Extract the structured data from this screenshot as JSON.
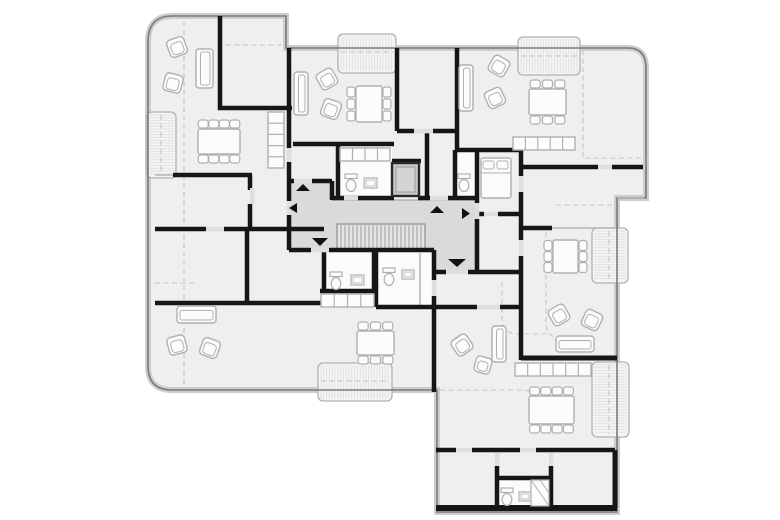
{
  "document": {
    "kind": "architectural-floor-plan",
    "canvas": {
      "width": 780,
      "height": 520
    }
  },
  "palette": {
    "background": "#ffffff",
    "room_fill": "#efefef",
    "corridor_fill": "#dadada",
    "stairs_fill": "#e4e4e4",
    "white_room_fill": "#fbfbfb",
    "balcony_fill": "#f4f4f4",
    "balcony_hatch": "#e2e2e2",
    "outline_soft": "#cdcdcd",
    "outline_dark": "#7a7a7a",
    "wall_black": "#161616",
    "gray_wall": "#b5b5b5",
    "door_sill": "#dedede",
    "dashed_line": "#c4c4c4",
    "furniture_fill": "#fcfcfc",
    "furniture_stroke": "#b0b0b0",
    "arrow_fill": "#111111",
    "elevator_fill": "#c9c9c9",
    "elevator_stroke": "#2a2a2a",
    "tread_stroke": "#8f8f8f"
  },
  "floor_plan": {
    "footprint_path": "M 172,16 L 286,16 L 286,48 L 628,48 Q 646,48 646,68 L 646,198 L 617,198 L 617,512 L 437,512 L 437,390 L 172,390 Q 148,390 148,366 L 148,42 Q 148,16 172,16 Z",
    "corridor_path": "M 289,181 L 332,181 L 332,200 L 477,200 L 477,272 L 434,272 L 434,250 L 289,250 Z",
    "stairs": {
      "x": 337,
      "y": 224,
      "w": 88,
      "h": 25,
      "tread_from": 341,
      "tread_to": 421,
      "tread_step": 4
    },
    "elevator": {
      "x": 392,
      "y": 163,
      "w": 27,
      "h": 33
    },
    "balconies": [
      {
        "x": 338,
        "y": 34,
        "w": 58,
        "h": 39,
        "hatch": "v"
      },
      {
        "x": 518,
        "y": 37,
        "w": 62,
        "h": 38,
        "hatch": "v"
      },
      {
        "x": 147,
        "y": 112,
        "w": 29,
        "h": 66,
        "hatch": "h"
      },
      {
        "x": 592,
        "y": 228,
        "w": 36,
        "h": 55,
        "hatch": "h"
      },
      {
        "x": 592,
        "y": 362,
        "w": 37,
        "h": 75,
        "hatch": "h"
      },
      {
        "x": 318,
        "y": 363,
        "w": 74,
        "h": 38,
        "hatch": "v"
      }
    ],
    "white_rooms": [
      {
        "x": 340,
        "y": 146,
        "w": 52,
        "h": 52
      },
      {
        "x": 456,
        "y": 152,
        "w": 20,
        "h": 45
      },
      {
        "x": 326,
        "y": 252,
        "w": 47,
        "h": 38
      },
      {
        "x": 378,
        "y": 252,
        "w": 55,
        "h": 54
      },
      {
        "x": 499,
        "y": 480,
        "w": 50,
        "h": 27
      }
    ],
    "walls": [
      [
        220,
        16,
        220,
        110
      ],
      [
        218,
        108,
        292,
        108
      ],
      [
        289,
        48,
        289,
        148
      ],
      [
        289,
        162,
        289,
        201
      ],
      [
        289,
        215,
        289,
        250
      ],
      [
        173,
        175,
        252,
        175
      ],
      [
        250,
        175,
        250,
        190
      ],
      [
        250,
        204,
        250,
        231
      ],
      [
        155,
        229,
        206,
        229
      ],
      [
        224,
        229,
        324,
        229
      ],
      [
        247,
        229,
        247,
        303
      ],
      [
        155,
        303,
        324,
        303
      ],
      [
        320,
        291,
        377,
        291
      ],
      [
        324,
        250,
        324,
        292
      ],
      [
        374,
        250,
        374,
        292
      ],
      [
        397,
        48,
        397,
        131
      ],
      [
        293,
        144,
        394,
        144
      ],
      [
        338,
        144,
        338,
        198
      ],
      [
        397,
        131,
        414,
        131
      ],
      [
        433,
        131,
        459,
        131
      ],
      [
        427,
        131,
        427,
        198
      ],
      [
        457,
        48,
        457,
        150
      ],
      [
        455,
        150,
        523,
        150
      ],
      [
        455,
        150,
        455,
        198
      ],
      [
        477,
        150,
        477,
        203
      ],
      [
        477,
        219,
        477,
        272
      ],
      [
        521,
        150,
        521,
        176
      ],
      [
        521,
        192,
        521,
        240
      ],
      [
        521,
        256,
        521,
        360
      ],
      [
        521,
        167,
        598,
        167
      ],
      [
        612,
        167,
        643,
        167
      ],
      [
        477,
        214,
        484,
        214
      ],
      [
        498,
        214,
        521,
        214
      ],
      [
        521,
        228,
        552,
        228
      ],
      [
        521,
        358,
        617,
        358,
        5
      ],
      [
        434,
        272,
        446,
        272
      ],
      [
        468,
        272,
        521,
        272
      ],
      [
        434,
        250,
        434,
        280
      ],
      [
        434,
        296,
        434,
        392
      ],
      [
        376,
        251,
        376,
        307
      ],
      [
        376,
        307,
        477,
        307
      ],
      [
        500,
        307,
        521,
        307
      ],
      [
        436,
        450,
        456,
        450
      ],
      [
        472,
        450,
        520,
        450
      ],
      [
        536,
        450,
        615,
        450
      ],
      [
        497,
        466,
        497,
        510
      ],
      [
        551,
        466,
        551,
        510
      ],
      [
        497,
        478,
        551,
        478
      ],
      [
        436,
        508,
        617,
        508,
        6
      ],
      [
        615,
        450,
        615,
        508,
        5
      ],
      [
        332,
        181,
        332,
        200
      ],
      [
        287,
        181,
        294,
        181
      ],
      [
        312,
        181,
        332,
        181
      ],
      [
        332,
        198,
        394,
        198
      ],
      [
        418,
        198,
        430,
        198
      ],
      [
        448,
        198,
        477,
        198
      ],
      [
        289,
        250,
        311,
        250
      ],
      [
        329,
        250,
        434,
        250
      ],
      [
        392,
        161,
        421,
        161
      ]
    ],
    "gray_walls": [
      [
        552,
        228,
        615,
        228
      ],
      [
        420,
        253,
        420,
        305
      ],
      [
        155,
        175,
        173,
        175
      ],
      [
        617,
        198,
        644,
        198
      ]
    ],
    "door_sills": [
      [
        294,
        178.8,
        18,
        4.5
      ],
      [
        311,
        247.8,
        18,
        4.5
      ],
      [
        286.8,
        148,
        4.5,
        14
      ],
      [
        286.8,
        201,
        4.5,
        14
      ],
      [
        430,
        195.8,
        18,
        4.5
      ],
      [
        474.8,
        203,
        4.5,
        16
      ],
      [
        446,
        269.8,
        22,
        4.5
      ],
      [
        414,
        128.8,
        19,
        4.5
      ],
      [
        206,
        226.8,
        18,
        4.5
      ],
      [
        250,
        188,
        4.5,
        16
      ],
      [
        484,
        211.8,
        14,
        4.5
      ],
      [
        518.8,
        176,
        4.5,
        16
      ],
      [
        518.8,
        240,
        4.5,
        16
      ],
      [
        477,
        304.8,
        23,
        4.5
      ],
      [
        456,
        447.8,
        16,
        4.5
      ],
      [
        520,
        447.8,
        16,
        4.5
      ],
      [
        494.8,
        453,
        4.5,
        13
      ],
      [
        548.8,
        453,
        4.5,
        13
      ],
      [
        431.8,
        280,
        4.5,
        16
      ],
      [
        598,
        164.8,
        14,
        4.5
      ],
      [
        344,
        195.8,
        14,
        4.5
      ]
    ],
    "dashed_lines": [
      "M184,22 V384",
      "M155,283 H194",
      "M226,45 H285",
      "M583,50 V158",
      "M585,158 H641",
      "M556,205 H612",
      "M502,282 V316 Q502,334 518,334 H548",
      "M546,232 V322 Q546,338 561,338",
      "M440,390 H518 Q542,390 547,405 V412",
      "M341,52 H393",
      "M521,56 H577",
      "M161,115 V175",
      "M609,231 V280",
      "M609,365 V434",
      "M321,381 H389"
    ],
    "arrows": [
      {
        "dir": "up",
        "points": "296,191 310,191 303,184"
      },
      {
        "dir": "left",
        "points": "297,203 297,213 289,208"
      },
      {
        "dir": "down",
        "points": "312,238 328,238 320,246"
      },
      {
        "dir": "up",
        "points": "430,213 444,213 437,206"
      },
      {
        "dir": "right",
        "points": "462,208 462,219 470,213.5"
      },
      {
        "dir": "down",
        "points": "448,259 466,259 457,267"
      }
    ],
    "furniture": {
      "sofas": [
        {
          "x": 196,
          "y": 49,
          "w": 17,
          "h": 39,
          "o": "v"
        },
        {
          "x": 294,
          "y": 72,
          "w": 14,
          "h": 43,
          "o": "v"
        },
        {
          "x": 459,
          "y": 65,
          "w": 14,
          "h": 46,
          "o": "v"
        },
        {
          "x": 177,
          "y": 306,
          "w": 39,
          "h": 17,
          "o": "h"
        },
        {
          "x": 556,
          "y": 336,
          "w": 38,
          "h": 16,
          "o": "h"
        },
        {
          "x": 492,
          "y": 326,
          "w": 14,
          "h": 36,
          "o": "v"
        }
      ],
      "armchairs": [
        {
          "cx": 177,
          "cy": 47,
          "s": 18,
          "r": -20
        },
        {
          "cx": 173,
          "cy": 83,
          "s": 18,
          "r": 15
        },
        {
          "cx": 327,
          "cy": 79,
          "s": 18,
          "r": -30
        },
        {
          "cx": 331,
          "cy": 109,
          "s": 18,
          "r": 20
        },
        {
          "cx": 499,
          "cy": 66,
          "s": 18,
          "r": 30
        },
        {
          "cx": 495,
          "cy": 98,
          "s": 18,
          "r": -25
        },
        {
          "cx": 177,
          "cy": 345,
          "s": 18,
          "r": -15
        },
        {
          "cx": 210,
          "cy": 348,
          "s": 18,
          "r": 20
        },
        {
          "cx": 559,
          "cy": 315,
          "s": 18,
          "r": -30
        },
        {
          "cx": 592,
          "cy": 320,
          "s": 18,
          "r": 25
        },
        {
          "cx": 462,
          "cy": 345,
          "s": 18,
          "r": -35
        },
        {
          "cx": 483,
          "cy": 365,
          "s": 16,
          "r": 15
        }
      ],
      "tables": [
        {
          "x": 198,
          "y": 129,
          "w": 42,
          "h": 25,
          "t": 4,
          "b": 4,
          "l": 0,
          "r": 0
        },
        {
          "x": 356,
          "y": 86,
          "w": 26,
          "h": 36,
          "t": 0,
          "b": 0,
          "l": 3,
          "r": 3
        },
        {
          "x": 529,
          "y": 89,
          "w": 37,
          "h": 26,
          "t": 3,
          "b": 3,
          "l": 0,
          "r": 0
        },
        {
          "x": 553,
          "y": 240,
          "w": 25,
          "h": 33,
          "t": 0,
          "b": 0,
          "l": 3,
          "r": 3
        },
        {
          "x": 357,
          "y": 331,
          "w": 37,
          "h": 24,
          "t": 3,
          "b": 3,
          "l": 0,
          "r": 0
        },
        {
          "x": 529,
          "y": 396,
          "w": 45,
          "h": 28,
          "t": 4,
          "b": 4,
          "l": 0,
          "r": 0
        }
      ],
      "kitchens": [
        {
          "x": 268,
          "y": 112,
          "w": 16,
          "h": 56,
          "cells": 5,
          "o": "v"
        },
        {
          "x": 340,
          "y": 148,
          "w": 50,
          "h": 13,
          "cells": 4,
          "o": "h"
        },
        {
          "x": 513,
          "y": 137,
          "w": 62,
          "h": 13,
          "cells": 5,
          "o": "h"
        },
        {
          "x": 321,
          "y": 294,
          "w": 53,
          "h": 13,
          "cells": 4,
          "o": "h"
        },
        {
          "x": 515,
          "y": 363,
          "w": 76,
          "h": 13,
          "cells": 6,
          "o": "h"
        }
      ],
      "beds": [
        {
          "x": 481,
          "y": 158,
          "w": 30,
          "h": 40
        }
      ],
      "toilets": [
        {
          "x": 345,
          "y": 174
        },
        {
          "x": 458,
          "y": 174
        },
        {
          "x": 330,
          "y": 272
        },
        {
          "x": 383,
          "y": 268
        },
        {
          "x": 501,
          "y": 488
        }
      ],
      "sinks": [
        {
          "x": 364,
          "y": 178,
          "w": 13,
          "h": 10
        },
        {
          "x": 351,
          "y": 275,
          "w": 13,
          "h": 10
        },
        {
          "x": 402,
          "y": 270,
          "w": 12,
          "h": 9
        },
        {
          "x": 519,
          "y": 492,
          "w": 12,
          "h": 9
        }
      ],
      "showers": [
        {
          "x": 531,
          "y": 480,
          "w": 18,
          "h": 26
        }
      ]
    }
  }
}
